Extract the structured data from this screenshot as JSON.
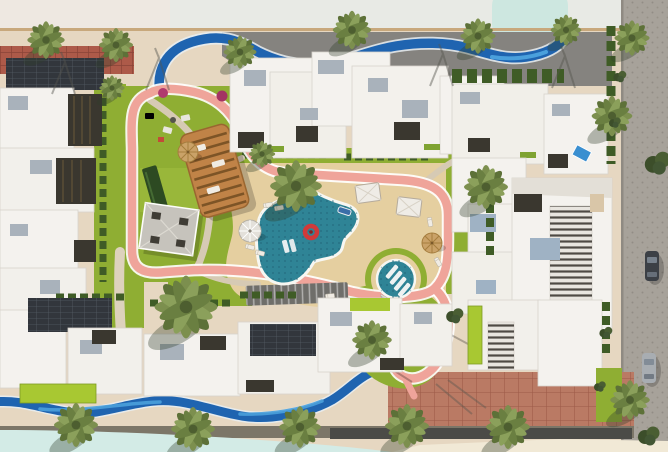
{
  "scene": {
    "title": "Residential compound master plan — aerial 3D render",
    "setting": "Top-down architectural visualization of a gated residential community with a central amenity courtyard",
    "parked_cars": 2,
    "features": [
      "white low-rise residential buildings framing the courtyard",
      "free-form swimming pool with red inflatable ring and floating loungers",
      "circular splash pool with in-water loungers",
      "sand beach pool deck with umbrellas, cabanas and sun loungers",
      "pink looping jogging track",
      "curved wooden pergola lounge",
      "gray seating pavilion",
      "triangular shade sail",
      "winding blue lazy-river channels at north and south edges",
      "lawns, hedges and palm trees",
      "brick promenade, perimeter sidewalks and cobbled access road with parked cars"
    ]
  },
  "colors": {
    "sidewalk": "#e6d7c1",
    "sky_band": "#e8eae5",
    "sky_band_left": "#efe7e0",
    "lagoon": "#d3ebe6",
    "lagoon_blob": "#cde7e0",
    "asphalt": "#85837f",
    "brick_top": "#ad5a49",
    "brick_bottom": "#ba7a64",
    "cobble": "#a7a29a",
    "curb": "#7c7668",
    "road_dark": "#4b4b47",
    "cream": "#f1e9d6",
    "building_white": "#f4f2ee",
    "building_edge": "#d7d3cc",
    "roof_gray": "#a9b2bb",
    "solar_dark": "#32363c",
    "slat_dark": "#3a372f",
    "lawn": "#8fae33",
    "lawn_light": "#a8c832",
    "hedge": "#3f5c26",
    "sand": "#e5cfa0",
    "pool": "#2f8496",
    "pool_tile": "#1f6376",
    "river": "#1f64b0",
    "river_light": "#4aa0dc",
    "track": "#efa49a",
    "path": "#d6cab4",
    "pergola_wood": "#c08347",
    "pergola_slat": "#7d5426",
    "pavilion_gray": "#c6c3bc",
    "sail_gray": "#bcbcb6",
    "trellis_dark": "#6f6e6a",
    "float_red": "#d03a3a",
    "car_dark": "#3c4046",
    "car_silver": "#a8adb2",
    "palm_frond": "#7c8f4e",
    "palm_frond_dark": "#5d7138"
  }
}
